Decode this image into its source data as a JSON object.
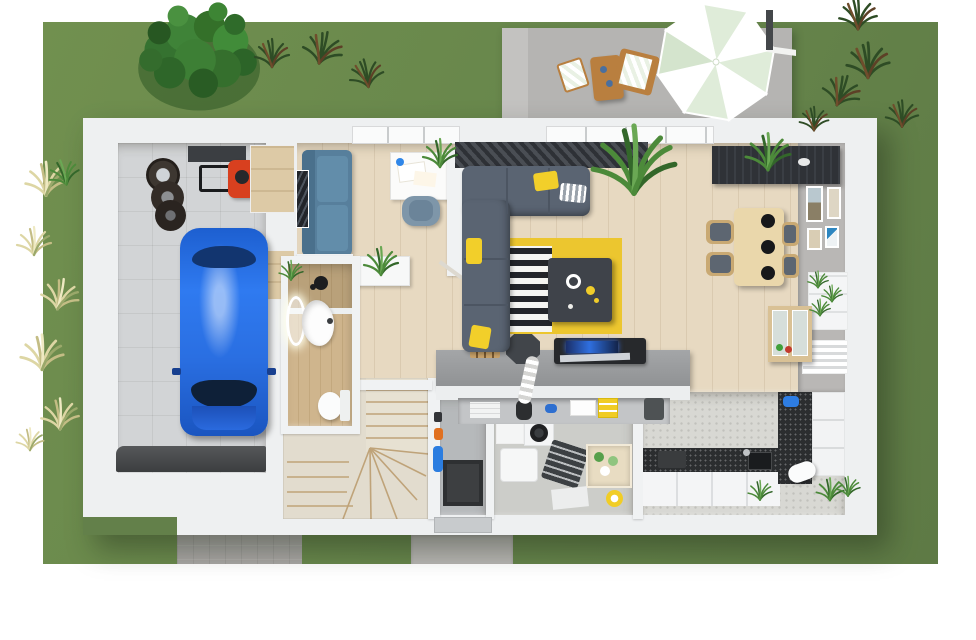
{
  "scene": {
    "description": "3D aerial render of a single-storey house floor plan with garden, terrace and driveway",
    "palette": {
      "lawn_green": "#6d8a52",
      "patio_concrete": "#b7b6b4",
      "driveway_gray": "#a8a6a3",
      "wall_white": "#f0f2f3",
      "wood_floor": "#e7d9c1",
      "bathroom_wood": "#cbb18a",
      "garage_tile": "#d2d4d6",
      "kitchen_floor": "#d8d8d3",
      "countertop_black": "#2b2d2f",
      "worktop_gray": "#97999b",
      "car_blue": "#2268dd",
      "mower_red": "#d8401f",
      "sofa_teal": "#577f9c",
      "sofa_gray": "#5a6472",
      "accent_yellow": "#f2cf2a",
      "curtain_dark": "#34373c",
      "dining_wood": "#ead7ab",
      "parasol_mint": "#dfecd9",
      "outdoor_wood": "#b97f3f",
      "plant_green": "#3f7d3a",
      "tuft_dark_green": "#2e4c25",
      "tuft_pale": "#ddd6a4"
    },
    "garden": {
      "elements": [
        "lawn",
        "large-tree",
        "dark-grass-tufts",
        "pale-grass-tufts",
        "driveway",
        "entrance-path"
      ]
    },
    "terrace": {
      "elements": [
        "concrete-patio",
        "cantilever-parasol",
        "outdoor-table",
        "striped-stool",
        "striped-lounge-chair"
      ]
    },
    "rooms": [
      {
        "name": "garage",
        "furniture": [
          "blue-car",
          "tire-stack",
          "lawn-mower",
          "wall-shelf",
          "storage-cabinets",
          "garage-door-mat"
        ]
      },
      {
        "name": "study",
        "furniture": [
          "teal-sofa",
          "white-desk",
          "desk-chair",
          "desk-plant",
          "wall-art"
        ]
      },
      {
        "name": "hallway",
        "furniture": [
          "console-table",
          "potted-plant",
          "open-door"
        ]
      },
      {
        "name": "bathroom",
        "furniture": [
          "illuminated-round-mirror",
          "washbasin",
          "toilet",
          "black-shower-fixture",
          "wood-plank-floor"
        ]
      },
      {
        "name": "staircase",
        "furniture": [
          "winder-stairs"
        ]
      },
      {
        "name": "utility-room",
        "furniture": [
          "dark-floor-mat",
          "wall-tools",
          "vacuum",
          "orange-cables"
        ]
      },
      {
        "name": "laundry-storage",
        "furniture": [
          "stacked-washer-dryer",
          "wood-cabinet",
          "drying-rack",
          "storage-crate",
          "laundry-basket",
          "detergent-box",
          "yellow-bucket",
          "white-mat"
        ]
      },
      {
        "name": "kitchen",
        "furniture": [
          "l-shaped-counter",
          "black-countertop",
          "sink",
          "cooktop",
          "tall-black-counter",
          "wall-cabinets",
          "stand-mixer",
          "sill-plants"
        ]
      },
      {
        "name": "breakfast-bar",
        "furniture": [
          "gray-worktop",
          "knife-block",
          "grinder",
          "laptop",
          "open-shelf-items"
        ]
      },
      {
        "name": "living-room",
        "furniture": [
          "corner-sofa",
          "yellow-cushions",
          "striped-cushion",
          "coffee-table",
          "yellow-rug",
          "striped-rug",
          "dark-curtains",
          "palm-plant"
        ]
      },
      {
        "name": "dining-area",
        "furniture": [
          "dining-table",
          "dining-chairs",
          "black-placemats",
          "sideboard-with-plant",
          "gallery-frames",
          "plant-shelf",
          "display-cabinet",
          "radiator"
        ]
      }
    ],
    "counts": {
      "dining_chairs": 4,
      "gallery_frames": 4,
      "placemats": 3,
      "washer_drums": 2,
      "terrace_seats": 2
    }
  }
}
